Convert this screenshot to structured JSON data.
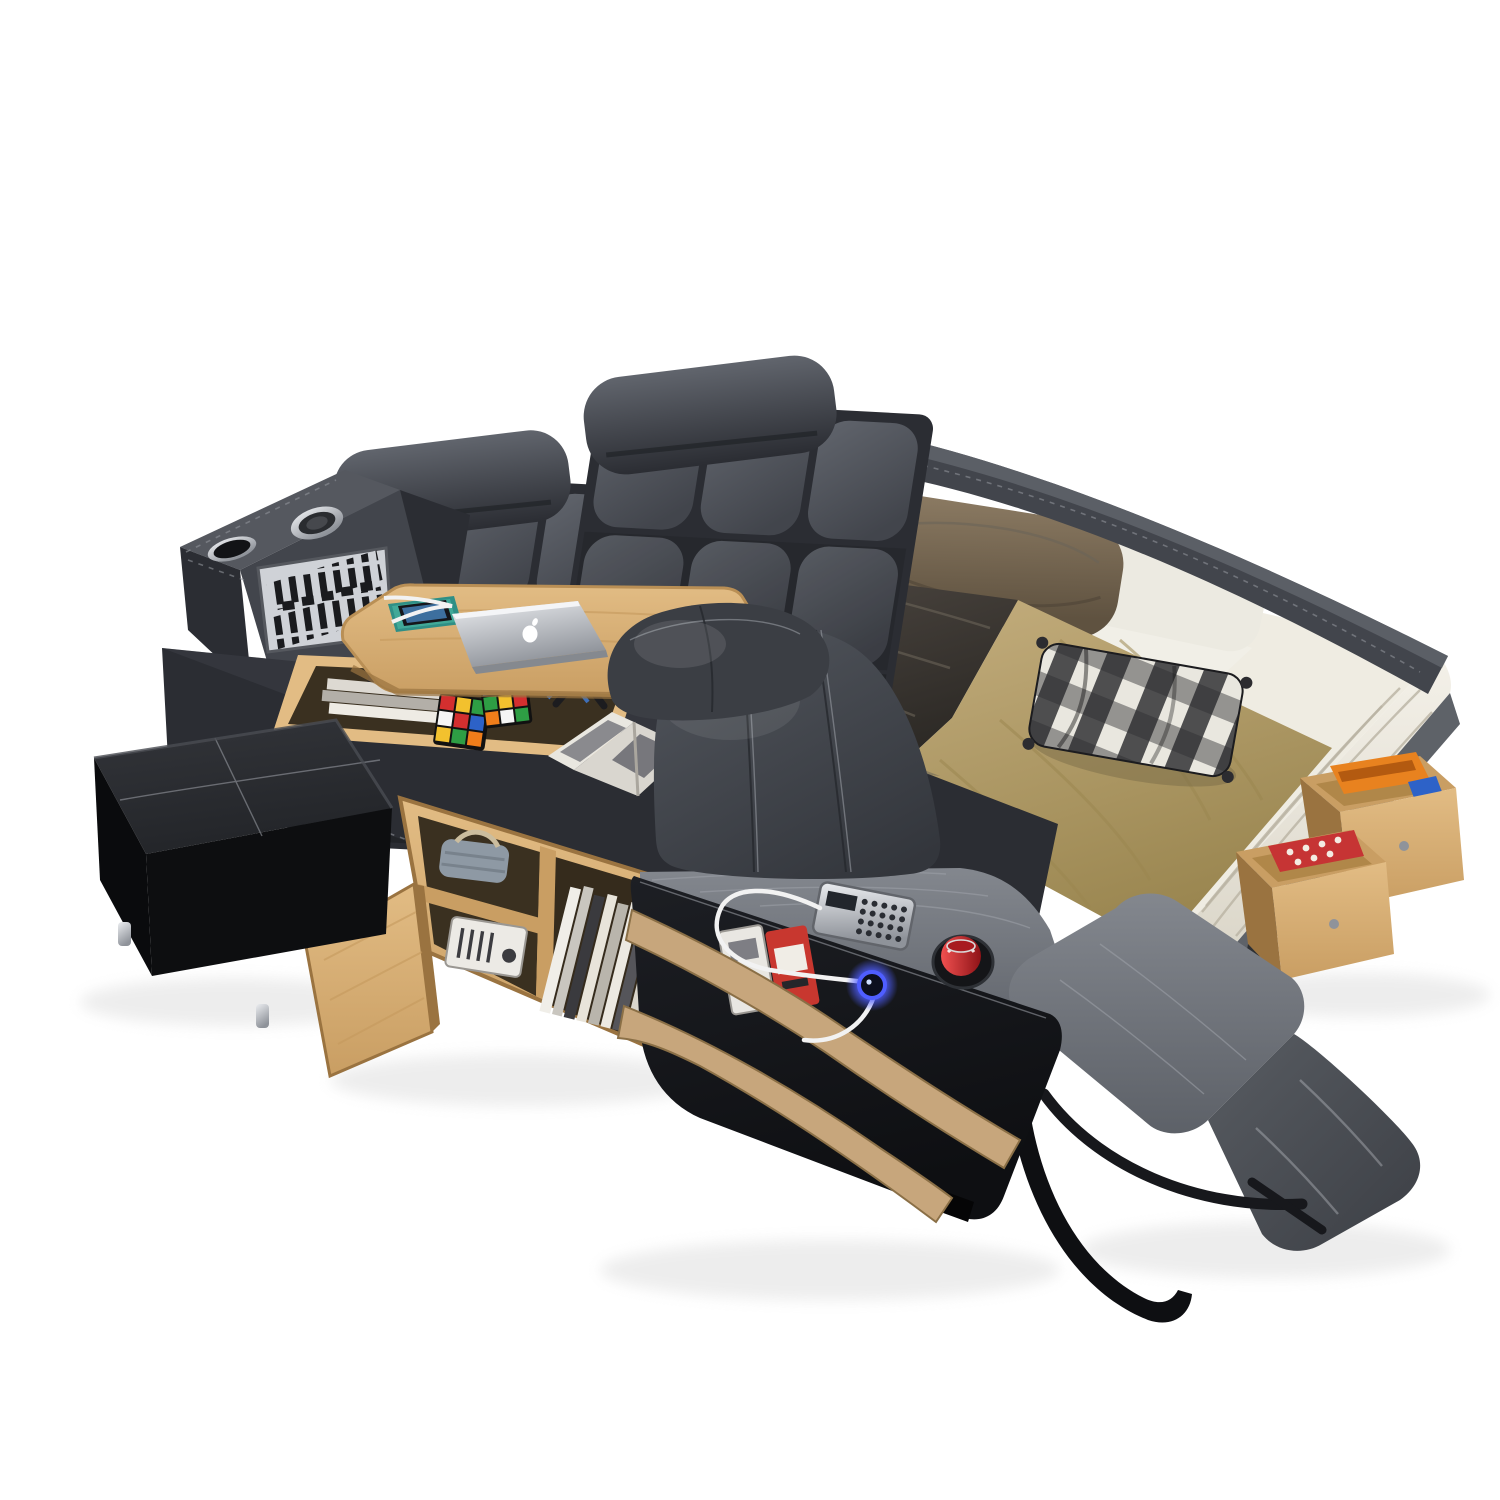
{
  "image": {
    "kind": "product-photo",
    "caption": "Gray leather multifunctional smart bed with tufted headboard, speaker console, lift-up laptop desk, built-in massage recliner with extended footrest, side bookshelf, storage ottoman, open storage drawers and beige bedding on a white background"
  },
  "colors": {
    "bg": "#ffffff",
    "shadow": "#d8d8d8",
    "leather-hi": "#61656d",
    "leather": "#42454c",
    "leather-deep": "#2b2d33",
    "panel-dark": "#1d1f24",
    "panel-deeper": "#0e0f12",
    "ottoman": "#232529",
    "ottoman-deep": "#0d0e10",
    "recliner": "#50545b",
    "recliner-deep": "#33363c",
    "seat-gray": "#83878e",
    "seat-deep": "#5d6168",
    "foot-dark": "#585c62",
    "stripe-tan": "#c7a67c",
    "stripe-edge": "#8a6f46",
    "wood": "#e2bc84",
    "wood-mid": "#c99e63",
    "wood-deep": "#9a7340",
    "wood-dark-int": "#3a3020",
    "mattress": "#f4f1e9",
    "mattress-shade": "#d8d3c5",
    "sheet": "#f1efe7",
    "tan": "#c4ae7e",
    "tan-deep": "#9a8650",
    "satin": "#433d37",
    "satin-deep": "#2b2824",
    "pillow": "#8d7c64",
    "pillow-deep": "#5f5240",
    "plaid-light": "#e9e7df",
    "plaid-dark": "#2c2c30",
    "can-red": "#d2282e",
    "can-deep": "#8e1317",
    "glow-blue": "#4f5eff",
    "cable": "#f2f2f2",
    "metal": "#c9ccd1",
    "metal-deep": "#8f939a",
    "rubik-red": "#d32f2f",
    "rubik-green": "#2e9e44",
    "rubik-blue": "#2d62c8",
    "rubik-yellow": "#f2c12e",
    "rubik-orange": "#ef7d1a",
    "rubik-white": "#f5f5f5",
    "legs-blue": "#3f6fb8",
    "book-orange": "#e8821f",
    "textile-red": "#c63434"
  },
  "objects": {
    "bed": {
      "label": "multifunctional smart bed"
    },
    "headboard_left": {
      "label": "tufted leather headboard panel, left"
    },
    "headboard_right": {
      "label": "tufted leather headboard panel, right"
    },
    "headrest_left": {
      "label": "adjustable headrest cushion, left"
    },
    "headrest_right": {
      "label": "adjustable headrest cushion, right"
    },
    "console": {
      "label": "corner media console"
    },
    "console_speaker": {
      "label": "round speaker on console top"
    },
    "console_cupholder": {
      "label": "cup holder on console top"
    },
    "console_grille": {
      "label": "metallic speaker grille panel"
    },
    "deck": {
      "label": "leather side deck platform"
    },
    "storage_well": {
      "label": "open storage well under desk"
    },
    "well_magazines": {
      "label": "magazines inside storage well"
    },
    "rubiks_cube_1": {
      "label": "rubik's cube"
    },
    "rubiks_cube_2": {
      "label": "rubik's cube"
    },
    "desk": {
      "label": "lift-up wooden laptop desk"
    },
    "desk_legs": {
      "label": "folding desk legs"
    },
    "laptop": {
      "label": "silver laptop with white logo"
    },
    "apple_logo": {
      "label": "white apple logo on laptop lid"
    },
    "phone": {
      "label": "smartphone on patterned pad"
    },
    "bookshelf": {
      "label": "wooden side bookshelf"
    },
    "bookshelf_door": {
      "label": "open wooden cabinet door"
    },
    "basket": {
      "label": "storage basket on shelf"
    },
    "radio": {
      "label": "small radio on shelf"
    },
    "books": {
      "label": "books and magazines on shelf"
    },
    "ottoman": {
      "label": "black leather storage ottoman"
    },
    "ottoman_feet": {
      "label": "metal ottoman feet"
    },
    "mattress": {
      "label": "mattress with white sheet"
    },
    "sheet": {
      "label": "white sheet"
    },
    "satin_blanket": {
      "label": "dark satin throw"
    },
    "tan_blanket": {
      "label": "beige blanket runner"
    },
    "pillow_left": {
      "label": "brown velvet pillow, left"
    },
    "pillow_right": {
      "label": "brown velvet pillow, right"
    },
    "pillow_white": {
      "label": "white pillow"
    },
    "plaid_pillow": {
      "label": "black and white checked cushion"
    },
    "side_rail": {
      "label": "curved leather side rail"
    },
    "platform_side": {
      "label": "bed platform side"
    },
    "drawer_upper": {
      "label": "open storage drawer with orange book"
    },
    "drawer_lower": {
      "label": "open storage drawer with red textile"
    },
    "recliner": {
      "label": "built-in massage recliner"
    },
    "recliner_headrest": {
      "label": "recliner headrest cushion"
    },
    "recliner_backrest": {
      "label": "recliner backrest"
    },
    "recliner_seat": {
      "label": "recliner seat and armrest"
    },
    "footrest_upper": {
      "label": "extended footrest, upper pad"
    },
    "footrest_lower": {
      "label": "extended footrest, lower pad"
    },
    "support_bar": {
      "label": "footrest support bar"
    },
    "strap": {
      "label": "black strap loop"
    },
    "side_panel": {
      "label": "black leather side panel"
    },
    "stripe_trim": {
      "label": "tan trim stripes"
    },
    "magazine_pocket": {
      "label": "side magazine pocket"
    },
    "keypad": {
      "label": "wired massage control keypad"
    },
    "soda_can": {
      "label": "red soda can in cup holder"
    },
    "usb_glow": {
      "label": "glowing blue usb power ring"
    },
    "usb_cable": {
      "label": "white usb cable"
    },
    "open_magazine": {
      "label": "open magazine on deck"
    }
  }
}
